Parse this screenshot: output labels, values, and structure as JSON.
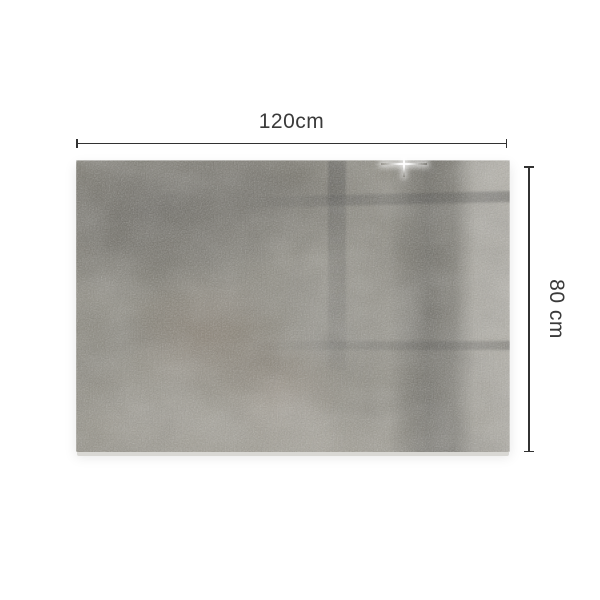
{
  "diagram": {
    "width_label": "120cm",
    "height_label": "80 cm",
    "annotation_color": "#323232",
    "label_color": "#3a3a3a",
    "background": "#ffffff",
    "panel_colors": {
      "base": "#878479",
      "dark_shadow": "#55544f",
      "light": "#b0aca1",
      "rust": "#8b6a52",
      "glass_edge": "#d9d8d4",
      "sparkle": "#ffffff"
    }
  }
}
